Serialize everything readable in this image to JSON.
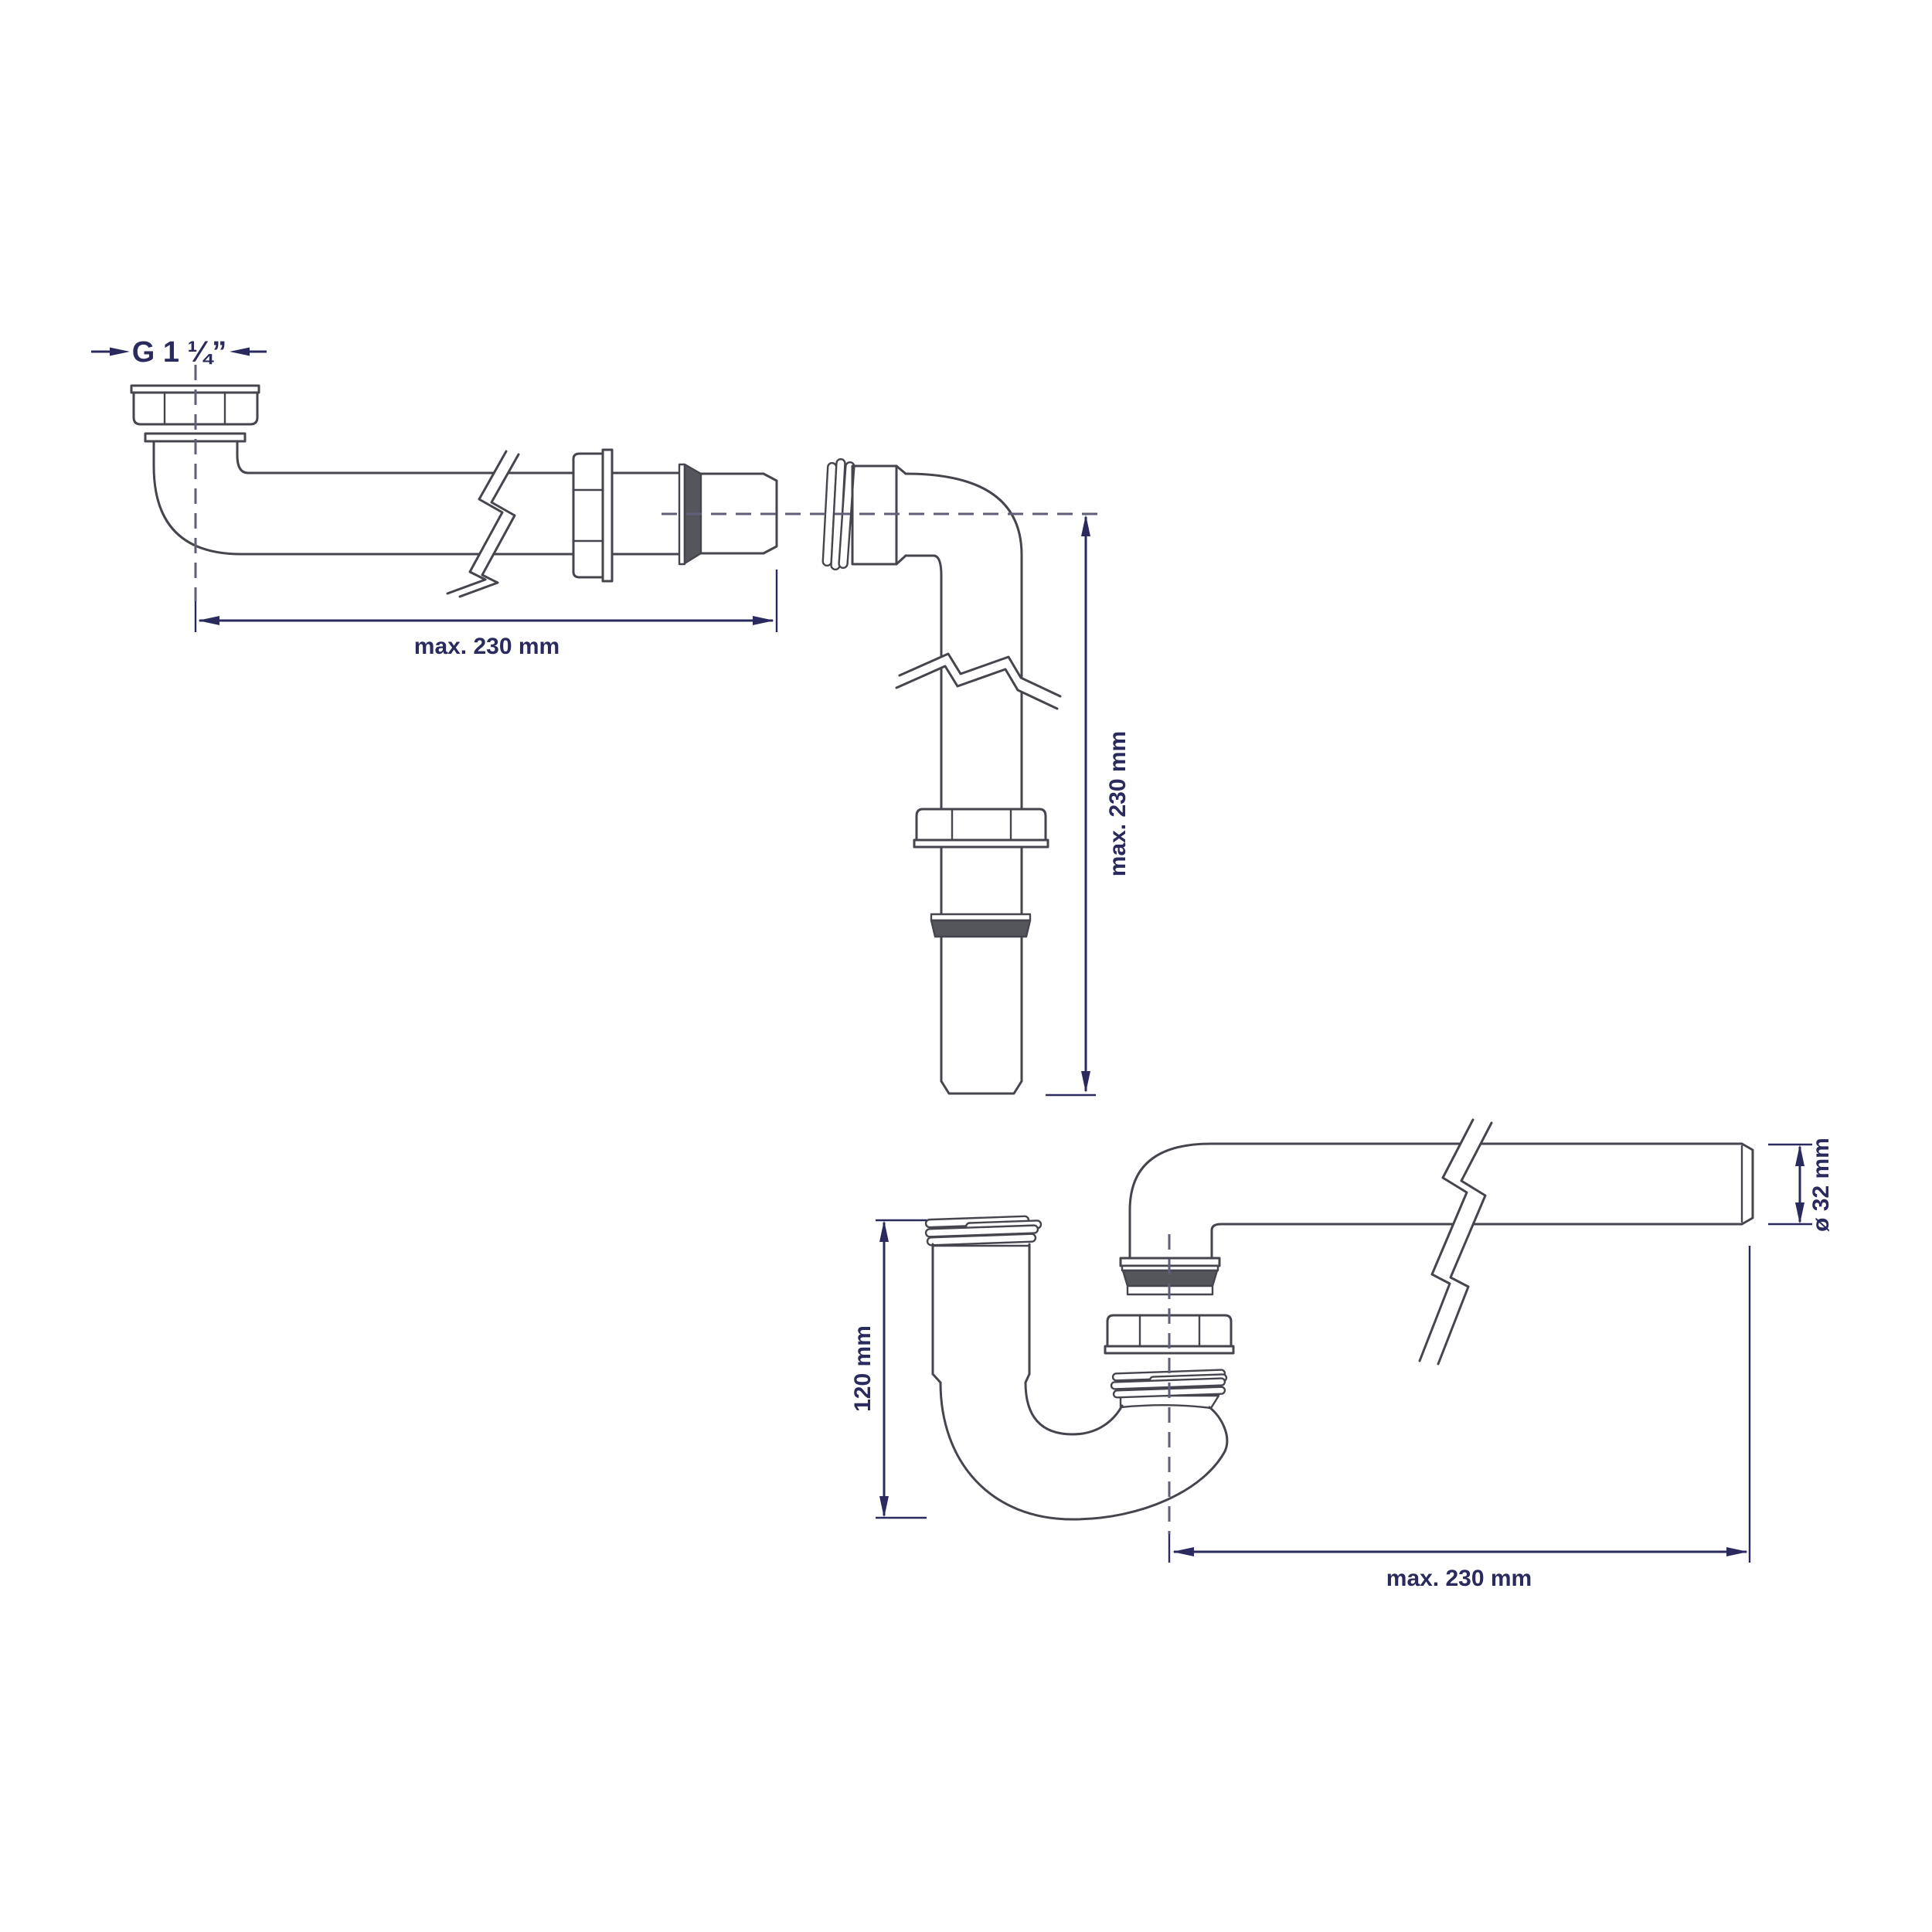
{
  "title": "Siphon technical drawing",
  "labels": {
    "thread_size": "G 1 ¼”",
    "dim_top_horizontal": "max. 230 mm",
    "dim_vertical_right": "max. 230 mm",
    "dim_trap_height": "120 mm",
    "dim_pipe_diameter": "ø 32 mm",
    "dim_bottom_horizontal": "max. 230 mm"
  },
  "colors": {
    "outline": "#45454d",
    "seal_fill": "#55555c",
    "dimension": "#2a2a5e",
    "centerline": "#5f5f78",
    "background": "#ffffff"
  }
}
